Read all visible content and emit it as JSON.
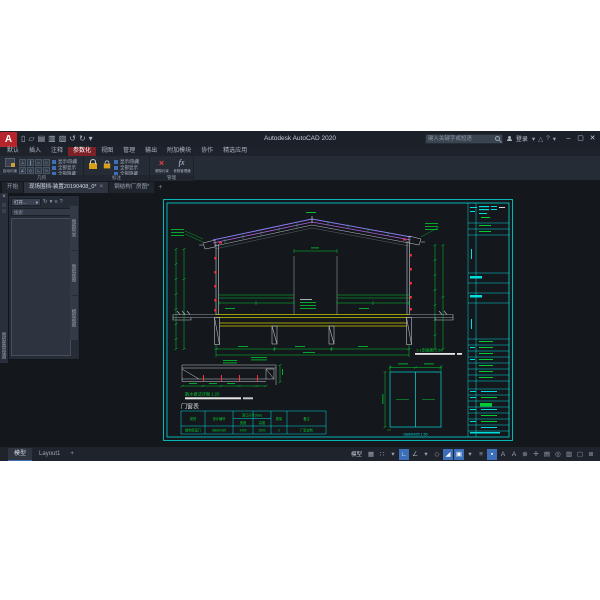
{
  "window": {
    "title": "Autodesk AutoCAD 2020",
    "search_placeholder": "键入关键字或短语",
    "sign_in_label": "登录",
    "controls": {
      "minimize": "–",
      "maximize": "▢",
      "close": "✕"
    },
    "title_icons": [
      {
        "name": "keep-list-dropdown-icon",
        "glyph": "▾"
      },
      {
        "name": "alert-icon",
        "glyph": "△"
      },
      {
        "name": "help-icon",
        "glyph": "?"
      },
      {
        "name": "help-dropdown-icon",
        "glyph": "▾"
      }
    ]
  },
  "quick_access": [
    {
      "name": "new-icon",
      "glyph": "▯"
    },
    {
      "name": "open-icon",
      "glyph": "▱"
    },
    {
      "name": "save-icon",
      "glyph": "▤"
    },
    {
      "name": "save-as-icon",
      "glyph": "▥"
    },
    {
      "name": "plot-icon",
      "glyph": "▨"
    },
    {
      "name": "undo-icon",
      "glyph": "↺"
    },
    {
      "name": "redo-icon",
      "glyph": "↻"
    },
    {
      "name": "qat-dropdown-icon",
      "glyph": "▾"
    }
  ],
  "ribbon": {
    "tabs": [
      {
        "label": "默认",
        "active": false
      },
      {
        "label": "插入",
        "active": false
      },
      {
        "label": "注释",
        "active": false
      },
      {
        "label": "参数化",
        "active": true
      },
      {
        "label": "视图",
        "active": false
      },
      {
        "label": "管理",
        "active": false
      },
      {
        "label": "输出",
        "active": false
      },
      {
        "label": "附加模块",
        "active": false
      },
      {
        "label": "协作",
        "active": false
      },
      {
        "label": "精选应用",
        "active": false
      }
    ],
    "panels": [
      {
        "label": "几何",
        "big_button": "自动约束",
        "rows": [
          "显示/隐藏",
          "全部显示",
          "全部隐藏"
        ]
      },
      {
        "label": "标注",
        "big_button": "线性",
        "rows": [
          "显示/隐藏",
          "全部显示",
          "全部隐藏"
        ]
      },
      {
        "label": "管理",
        "items": [
          "删除约束",
          "参数管理器"
        ]
      }
    ],
    "constraint_glyphs": [
      "⊥",
      "∥",
      "=",
      "○",
      "∠",
      "◇",
      "∟",
      "≈"
    ]
  },
  "file_tabs": [
    {
      "label": "开始",
      "active": false,
      "closable": false
    },
    {
      "label": "现场围挡-装置20190408_0*",
      "active": true,
      "closable": true,
      "close_glyph": "×"
    },
    {
      "label": "钢结构厂房图*",
      "active": false,
      "closable": false
    },
    {
      "label": "+",
      "active": false,
      "is_button": true
    }
  ],
  "palette": {
    "side_title": "图纸集管理器",
    "dropdown_value": "打开...",
    "dropdown_arrow": "▾",
    "header_icons": [
      {
        "name": "refresh-icon",
        "glyph": "↻"
      },
      {
        "name": "list-dropdown-icon",
        "glyph": "▾"
      },
      {
        "name": "details-icon",
        "glyph": "≡"
      },
      {
        "name": "help-icon",
        "glyph": "?"
      }
    ],
    "search_placeholder": "搜索",
    "tabs": [
      "图纸列表",
      "图纸视图",
      "模型视图"
    ]
  },
  "sheet": {
    "table": {
      "title": "门窗表",
      "col_category": "类别",
      "col_code": "设计编号",
      "col_size": "洞口尺寸(mm)",
      "col_width": "宽度",
      "col_height": "高度",
      "col_qty": "数量",
      "col_note": "备注",
      "row": {
        "category": "钢制保温门",
        "code": "GBM2425",
        "width": "2400",
        "height": "2500",
        "qty": "2",
        "note": "厂家定制"
      }
    },
    "titles": {
      "section": "1-1剖面图 1:50",
      "detail": "散水做法详图 1:20",
      "door": "GBM2425 1:50"
    }
  },
  "layout_tabs": [
    {
      "label": "模型",
      "active": true
    },
    {
      "label": "Layout1",
      "active": false
    },
    {
      "label": "+",
      "is_button": true
    }
  ],
  "status": {
    "model_label": "模型",
    "icons": [
      {
        "name": "grid-icon",
        "glyph": "▦",
        "active": false
      },
      {
        "name": "snap-icon",
        "glyph": "∷",
        "active": false
      },
      {
        "name": "snap-dropdown-icon",
        "glyph": "▾",
        "active": false
      },
      {
        "name": "ortho-icon",
        "glyph": "∟",
        "active": true
      },
      {
        "name": "polar-icon",
        "glyph": "∠",
        "active": false
      },
      {
        "name": "polar-dropdown-icon",
        "glyph": "▾",
        "active": false
      },
      {
        "name": "isodraft-icon",
        "glyph": "◇",
        "active": false
      },
      {
        "name": "osnap-track-icon",
        "glyph": "◢",
        "active": true
      },
      {
        "name": "osnap-icon",
        "glyph": "▣",
        "active": true
      },
      {
        "name": "osnap-dropdown-icon",
        "glyph": "▾",
        "active": false
      },
      {
        "name": "lineweight-icon",
        "glyph": "≡",
        "active": false
      },
      {
        "name": "dynamic-input-icon",
        "glyph": "▪",
        "active": true
      },
      {
        "name": "annotation-visibility-icon",
        "glyph": "A",
        "active": false
      },
      {
        "name": "annotation-autoscale-icon",
        "glyph": "A",
        "active": false
      },
      {
        "name": "annotation-scale-icon",
        "glyph": "⊕",
        "active": false
      },
      {
        "name": "workspace-icon",
        "glyph": "✛",
        "active": false
      },
      {
        "name": "quick-properties-icon",
        "glyph": "▤",
        "active": false
      },
      {
        "name": "isolate-objects-icon",
        "glyph": "◎",
        "active": false
      },
      {
        "name": "graphics-performance-icon",
        "glyph": "▥",
        "active": false
      },
      {
        "name": "clean-screen-icon",
        "glyph": "▢",
        "active": false
      },
      {
        "name": "customization-icon",
        "glyph": "≣",
        "active": false
      }
    ]
  },
  "colors": {
    "accent_red": "#b6252b",
    "ribbon_tab_active": "#7e2027",
    "cad_cyan": "#00dede",
    "cad_green": "#00cc33",
    "cad_yellow": "#cece00",
    "cad_purple": "#8878f0",
    "cad_magenta": "#b060e0",
    "cad_red": "#ff3030",
    "status_active_blue": "#3d6fb8"
  }
}
